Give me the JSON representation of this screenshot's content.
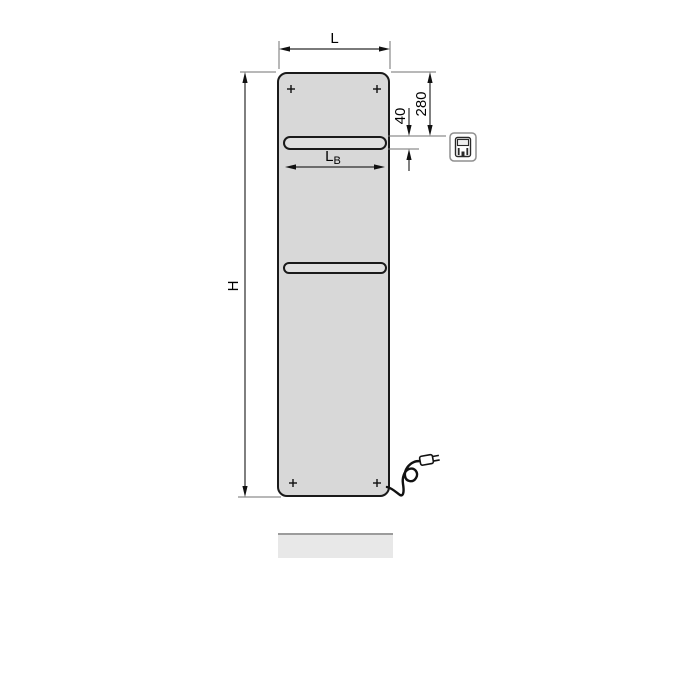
{
  "figure": {
    "title": "radiator-dimension-diagram",
    "dimension_labels": {
      "overall_width": "L",
      "overall_height": "H",
      "rail_width_main": "L",
      "rail_width_subscript": "B",
      "top_to_rail": "280",
      "rail_height": "40"
    },
    "icons": {
      "control": "electric-control-icon",
      "plug": "power-plug-icon"
    },
    "colors": {
      "panel_fill": "#d8d8d8",
      "rail_fill": "#e0e0e0",
      "outline": "#1a1a1a",
      "dimension_line": "#2b2b2b",
      "extension_line": "#707070",
      "shadow_fill": "#e8e8e8",
      "shadow_edge": "#9c9c9c",
      "background": "#ffffff"
    }
  }
}
